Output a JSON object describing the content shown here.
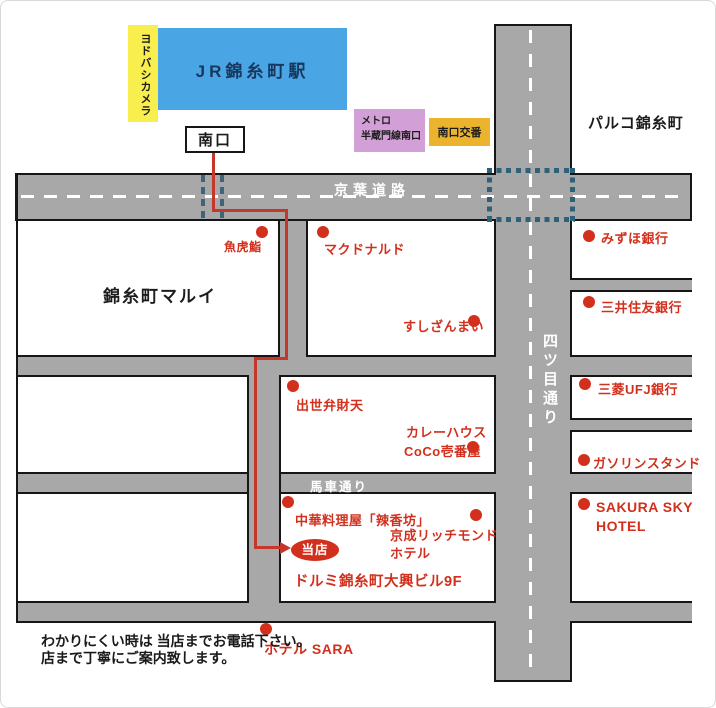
{
  "landmarks": {
    "yodobashi": "ヨドバシカメラ",
    "jr_station": "JR錦糸町駅",
    "south_exit": "南口",
    "metro_l1": "メトロ",
    "metro_l2": "半蔵門線南口",
    "koban": "南口交番",
    "parco": "パルコ錦糸町",
    "marui": "錦糸町マルイ"
  },
  "roads": {
    "keiyo": "京葉道路",
    "yotsume": "四ツ目通り",
    "basha": "馬車通り"
  },
  "pois": [
    {
      "label": "魚虎鮨"
    },
    {
      "label": "マクドナルド"
    },
    {
      "label": "すしざんまい"
    },
    {
      "label": "みずほ銀行"
    },
    {
      "label": "三井住友銀行"
    },
    {
      "label": "三菱UFJ銀行"
    },
    {
      "label": "ガソリンスタンド"
    },
    {
      "label": "SAKURA SKY",
      "label2": "HOTEL"
    },
    {
      "label": "出世弁財天"
    },
    {
      "label": "カレーハウス",
      "label2": "CoCo壱番屋"
    },
    {
      "label": "中華料理屋「辣香坊」"
    },
    {
      "label": "京成リッチモンド",
      "label2": "ホテル"
    },
    {
      "label": "ホテル SARA"
    }
  ],
  "shop": {
    "marker": "当店",
    "building": "ドルミ錦糸町大興ビル9F"
  },
  "note": {
    "line1": "わかりにくい時は 当店までお電話下さい。",
    "line2": "店まで丁寧にご案内致します。"
  },
  "colors": {
    "station_blue": "#4aa5e5",
    "station_text": "#17375e",
    "yodobashi_yellow": "#f8ee4d",
    "metro_purple": "#d2a0d6",
    "koban_orange": "#ecb32e",
    "road_gray": "#a8a8a8",
    "marker_red": "#d2301d",
    "route_red": "#c5372b",
    "crosswalk_blue": "#2e6078"
  }
}
